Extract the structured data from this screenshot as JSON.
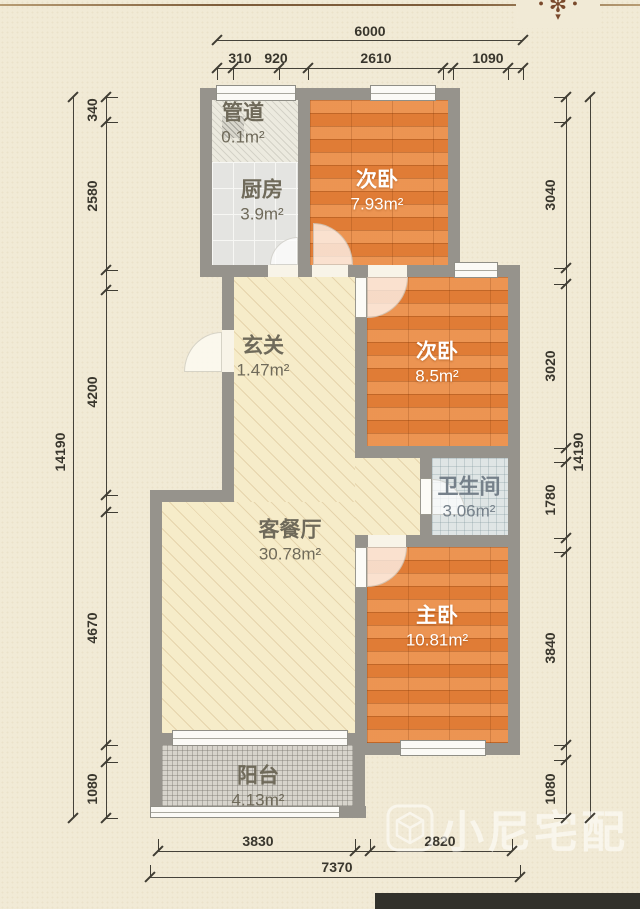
{
  "page": {
    "watermark_text": "小尼宅配",
    "ornament_flower": "✻",
    "ornament_dot_left": "●",
    "ornament_dot_right": "●",
    "ornament_tail": "▾",
    "background_color": "#f1ead6",
    "wall_color": "#96938c",
    "wood_floor_color": "#e8843c",
    "cream_floor_color": "#f6ecc9"
  },
  "rooms": [
    {
      "name": "管道",
      "area": "0.1m²"
    },
    {
      "name": "厨房",
      "area": "3.9m²"
    },
    {
      "name": "次卧",
      "area": "7.93m²"
    },
    {
      "name": "玄关",
      "area": "1.47m²"
    },
    {
      "name": "次卧",
      "area": "8.5m²"
    },
    {
      "name": "卫生间",
      "area": "3.06m²"
    },
    {
      "name": "客餐厅",
      "area": "30.78m²"
    },
    {
      "name": "主卧",
      "area": "10.81m²"
    },
    {
      "name": "阳台",
      "area": "4.13m²"
    }
  ],
  "dimensions": {
    "top": {
      "total": "6000",
      "segments": [
        "310",
        "920",
        "2610",
        "1090"
      ]
    },
    "bottom": {
      "total": "7370",
      "segments": [
        "3830",
        "2820"
      ]
    },
    "left": {
      "total": "14190",
      "segments": [
        "340",
        "2580",
        "4200",
        "4670",
        "1080"
      ]
    },
    "right": {
      "total": "14190",
      "segments": [
        "3040",
        "3020",
        "1780",
        "3840",
        "1080"
      ]
    }
  }
}
